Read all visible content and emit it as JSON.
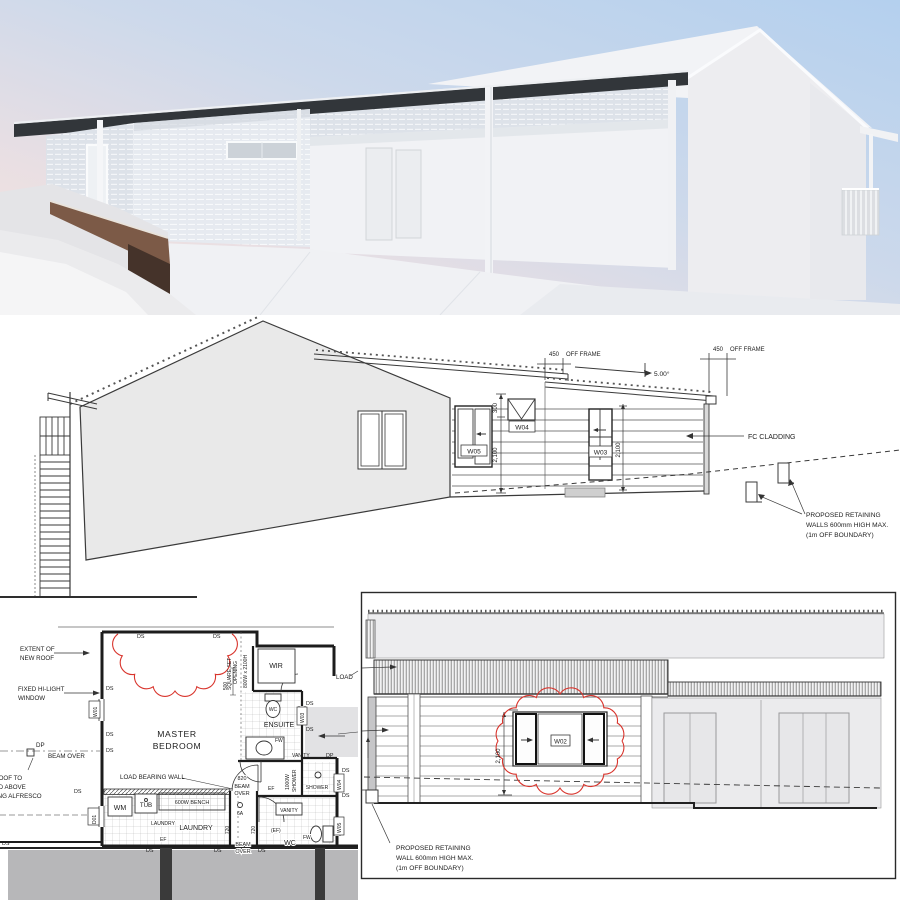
{
  "windows": {
    "w01": "W01",
    "w02": "W02",
    "w03": "W03",
    "w04": "W04",
    "w05": "W05",
    "d01": "D01"
  },
  "glossary": {
    "ds": "DS",
    "dp": "DP",
    "fw": "FW",
    "wc": "WC",
    "ef": "EF",
    "ef_paren": "(EF)",
    "vanity": "VANITY",
    "beam": "BEAM",
    "over": "OVER",
    "beam_over": "BEAM OVER",
    "dim_450": "450",
    "off_frame": "OFF FRAME",
    "dim_2100": "2,100",
    "dim_720": "720"
  },
  "side_elevation": {
    "slope_label": "5.00°",
    "dim_300": "300",
    "fc_cladding": "FC CLADDING",
    "retaining_note": {
      "line1": "PROPOSED RETAINING",
      "line2": "WALLS 600mm HIGH MAX.",
      "line3": "(1m OFF BOUNDARY)"
    }
  },
  "floor_plan": {
    "extent_note": {
      "line1": "EXTENT OF",
      "line2": "NEW ROOF"
    },
    "hilight_note": {
      "line1": "FIXED HI-LIGHT",
      "line2": "WINDOW"
    },
    "alfresco_note": {
      "line1": "NEW ROOF TO",
      "line2": "EXTEND ABOVE",
      "line3": "EXISTING ALFRESCO"
    },
    "room_master": {
      "line1": "MASTER",
      "line2": "BEDROOM"
    },
    "square_set": {
      "line1": "SQUARE SET",
      "line2": "OPENING",
      "size": "800W x 2100H"
    },
    "room_wir": "WIR",
    "room_ensuite": "ENSUITE",
    "room_laundry": "LAUNDRY",
    "room_wc": "WC",
    "load_bearing_wall": "LOAD BEARING WALL",
    "load_cut": "LOAD",
    "dim_500": "500",
    "dim_820": "820",
    "switch_6a": "6A",
    "wm": "WM",
    "tub": "TUB",
    "bench": "600W BENCH",
    "shower": "SHOWER",
    "shower_width": "1000W"
  },
  "rear_elevation": {
    "retaining_note": {
      "line1": "PROPOSED RETAINING",
      "line2": "WALL 600mm HIGH MAX.",
      "line3": "(1m OFF BOUNDARY)"
    }
  },
  "colors": {
    "revision_red": "#d8342c",
    "existing_fill": "#e9e9e9",
    "deck_gray": "#b7b7b9",
    "fascia_dark": "#32363a",
    "sky_blue": "#b4d0ee",
    "sky_pink": "#f8e4dd"
  }
}
